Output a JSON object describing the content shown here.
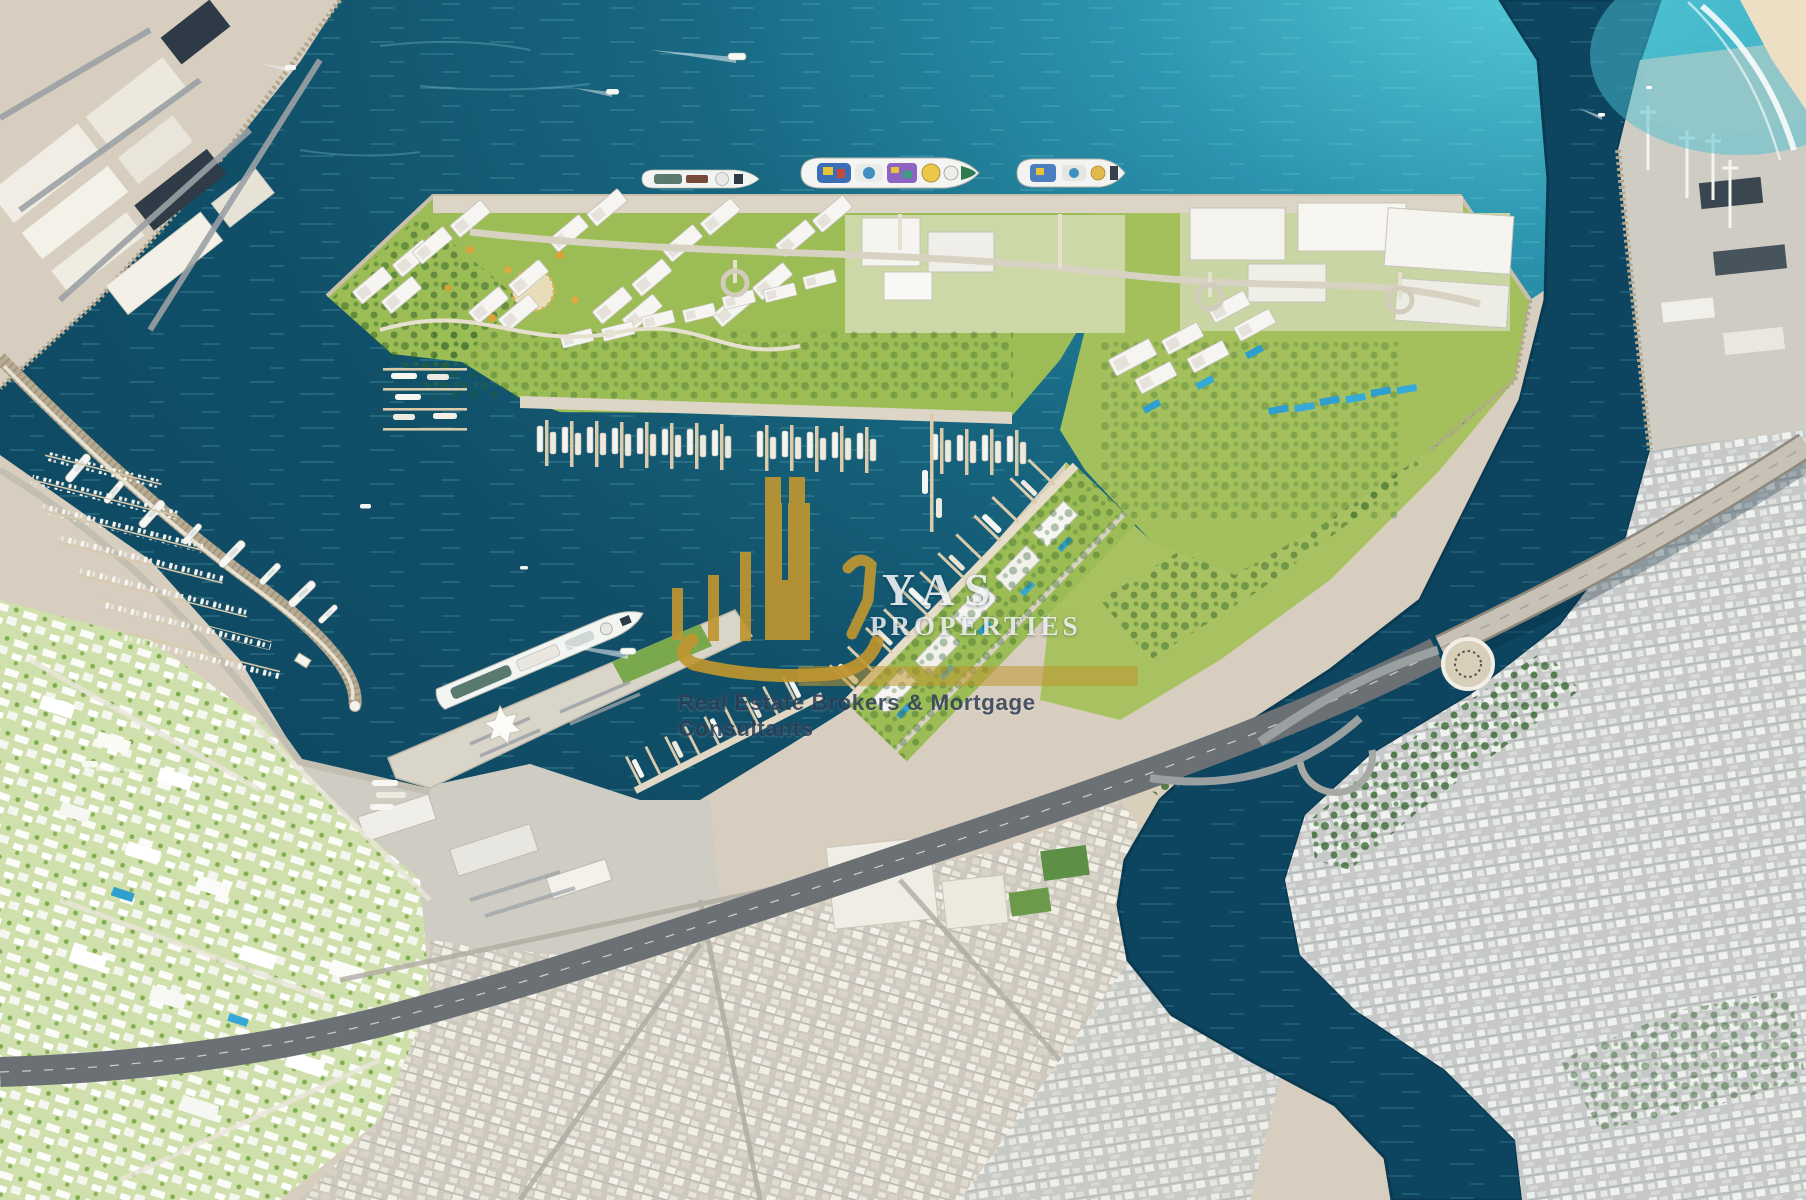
{
  "watermark": {
    "brand_line1": "YAS",
    "brand_line2": "PROPERTIES",
    "tagline": "Real Estate Brokers & Mortgage Consultants",
    "logo_gold": "#bf9630",
    "brand_text_color": "#f2f3f5",
    "tagline_color": "#2e3d55"
  },
  "scene": {
    "description": "Aerial masterplan rendering of a waterfront port development with cruise quay, marinas, cruise terminal pier, highway interchange and creek-side city",
    "palette": {
      "deep_water": "#114f68",
      "shallow_water": "#4fc3d4",
      "sand": "#d8cec0",
      "greenery": "#9cbd55",
      "dark_trees": "#2f6329",
      "buildings": "#f4f3ef",
      "roads": "#d3cec0",
      "highway": "#6a7074",
      "city_fabric": "#cdc9be",
      "pool_blue": "#2f9fd0",
      "pier_wood": "#dbcbab",
      "ship_deck_teal": "#5b7a6e"
    },
    "icon_legend": {
      "cruise-ship-icon": "docked cruise liner",
      "yacht-icon": "moored yacht",
      "speedboat-icon": "boat with white wake",
      "crane-icon": "port gantry crane",
      "roundabout-icon": "road roundabout",
      "star-roof-icon": "cruise terminal star-shaped roof"
    }
  }
}
